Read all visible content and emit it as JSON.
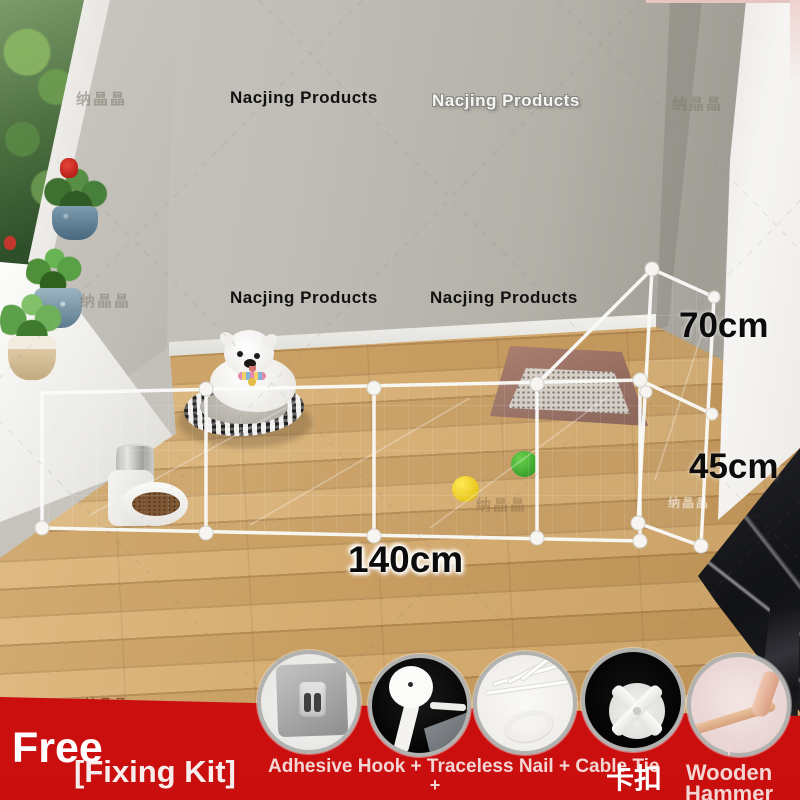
{
  "brand": {
    "cjk": "纳晶晶",
    "en": "Nacjing Products"
  },
  "labels": {
    "back_height": "70cm",
    "front_height": "45cm",
    "length": "140cm"
  },
  "banner": {
    "headline": "Free",
    "subline": "[Fixing Kit]",
    "items_caption": "Adhesive Hook + Traceless Nail + Cable Tie",
    "plus": "+",
    "buckle_caption": "卡扣",
    "hammer_plus": "+",
    "hammer_caption_1": "Wooden",
    "hammer_caption_2": "Hammer",
    "background": "#d6100f"
  },
  "thumbnails": [
    {
      "name": "adhesive-hook"
    },
    {
      "name": "traceless-nail"
    },
    {
      "name": "cable-tie"
    },
    {
      "name": "snap-buckle"
    },
    {
      "name": "wooden-hammer"
    }
  ],
  "colors": {
    "banner_red": "#d6100f",
    "wall_gray": "#bcb9b2",
    "floor_wood": "#d2a768",
    "fence_white": "#fbfbf9",
    "ball_yellow": "#e9c513",
    "ball_green": "#33a022",
    "tray_brown": "#91695b"
  }
}
